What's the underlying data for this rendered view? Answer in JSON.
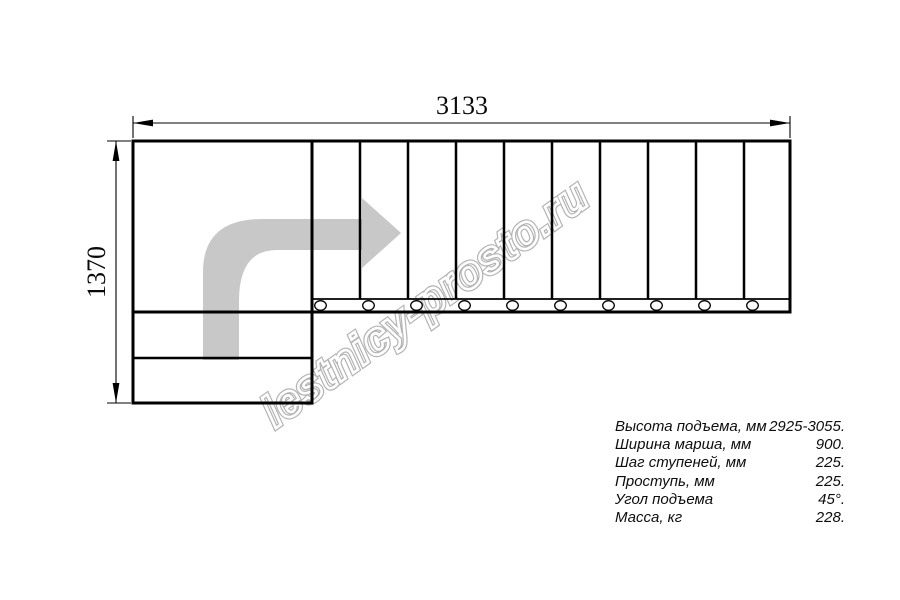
{
  "diagram": {
    "width_label": "3133",
    "height_label": "1370",
    "tread_count": 10,
    "bottom_step_count": 2
  },
  "watermark": {
    "text": "lestnicy-prosto.ru"
  },
  "specs": {
    "rows": [
      {
        "label": "Высота подъема, мм",
        "value": "2925-3055."
      },
      {
        "label": "Ширина марша, мм",
        "value": "900."
      },
      {
        "label": "Шаг ступеней, мм",
        "value": "225."
      },
      {
        "label": "Проступь, мм",
        "value": "225."
      },
      {
        "label": "Угол подъема",
        "value": "45°."
      },
      {
        "label": "Масса, кг",
        "value": "228."
      }
    ]
  },
  "colors": {
    "line": "#000000",
    "arrow_fill": "#c8c8c8",
    "watermark_gray": "#b3b3b3"
  }
}
